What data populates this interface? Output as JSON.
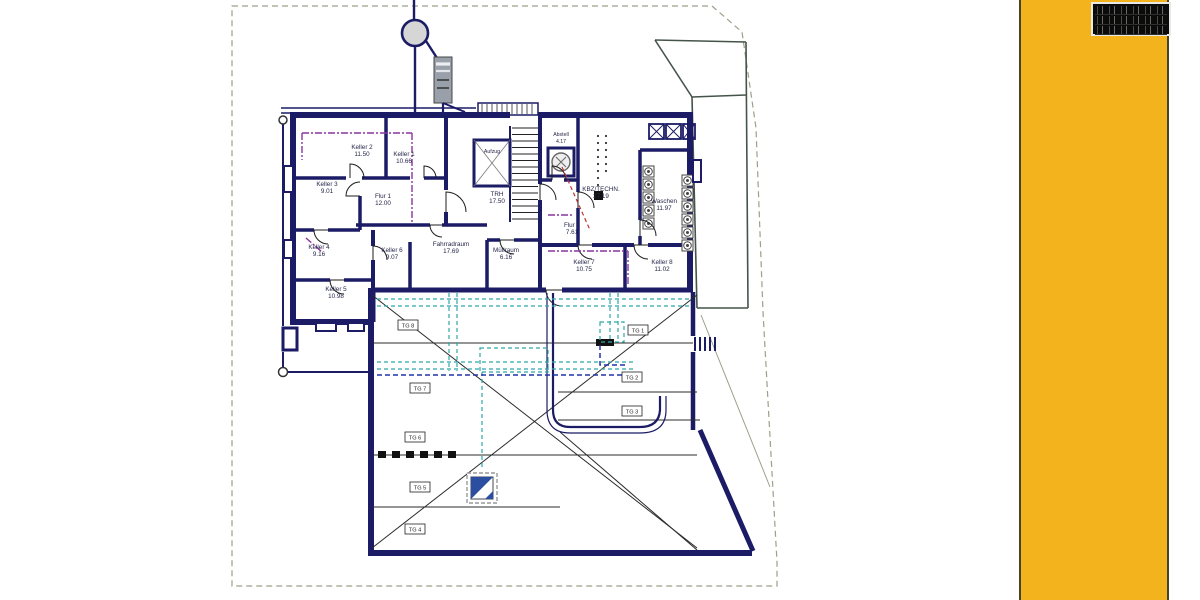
{
  "floor_label": "KG",
  "rooms": [
    {
      "name": "Keller 2",
      "area": "11.50"
    },
    {
      "name": "Keller 1",
      "area": "10.66"
    },
    {
      "name": "Keller 3",
      "area": "9.01"
    },
    {
      "name": "Flur 1",
      "area": "12.00"
    },
    {
      "name": "Keller 4",
      "area": "9.16"
    },
    {
      "name": "Keller 5",
      "area": "10.98"
    },
    {
      "name": "Keller 6",
      "area": "9.07"
    },
    {
      "name": "Fahrradraum",
      "area": "17.69"
    },
    {
      "name": "TRH",
      "area": "17.50"
    },
    {
      "name": "Aufzug",
      "area": ""
    },
    {
      "name": "Abstell",
      "area": "4.17"
    },
    {
      "name": "KBZ/TECHN.",
      "area": "27.19"
    },
    {
      "name": "Waschen",
      "area": "11.97"
    },
    {
      "name": "Flur 2",
      "area": "7.61"
    },
    {
      "name": "Müllraum",
      "area": "6.16"
    },
    {
      "name": "Keller 7",
      "area": "10.75"
    },
    {
      "name": "Keller 8",
      "area": "11.02"
    }
  ],
  "parking": [
    "TG 1",
    "TG 2",
    "TG 3",
    "TG 8",
    "TG 7",
    "TG 6",
    "TG 5",
    "TG 4"
  ],
  "colors": {
    "wall_navy": "#1b1b66",
    "accent_yellow": "#F2B31C",
    "duct_teal": "#2fa8a8",
    "pipe_purple": "#8a35a0",
    "escape_red": "#c03333",
    "boundary_gray": "#9aa089",
    "logo_blue": "#2b4ea0"
  }
}
